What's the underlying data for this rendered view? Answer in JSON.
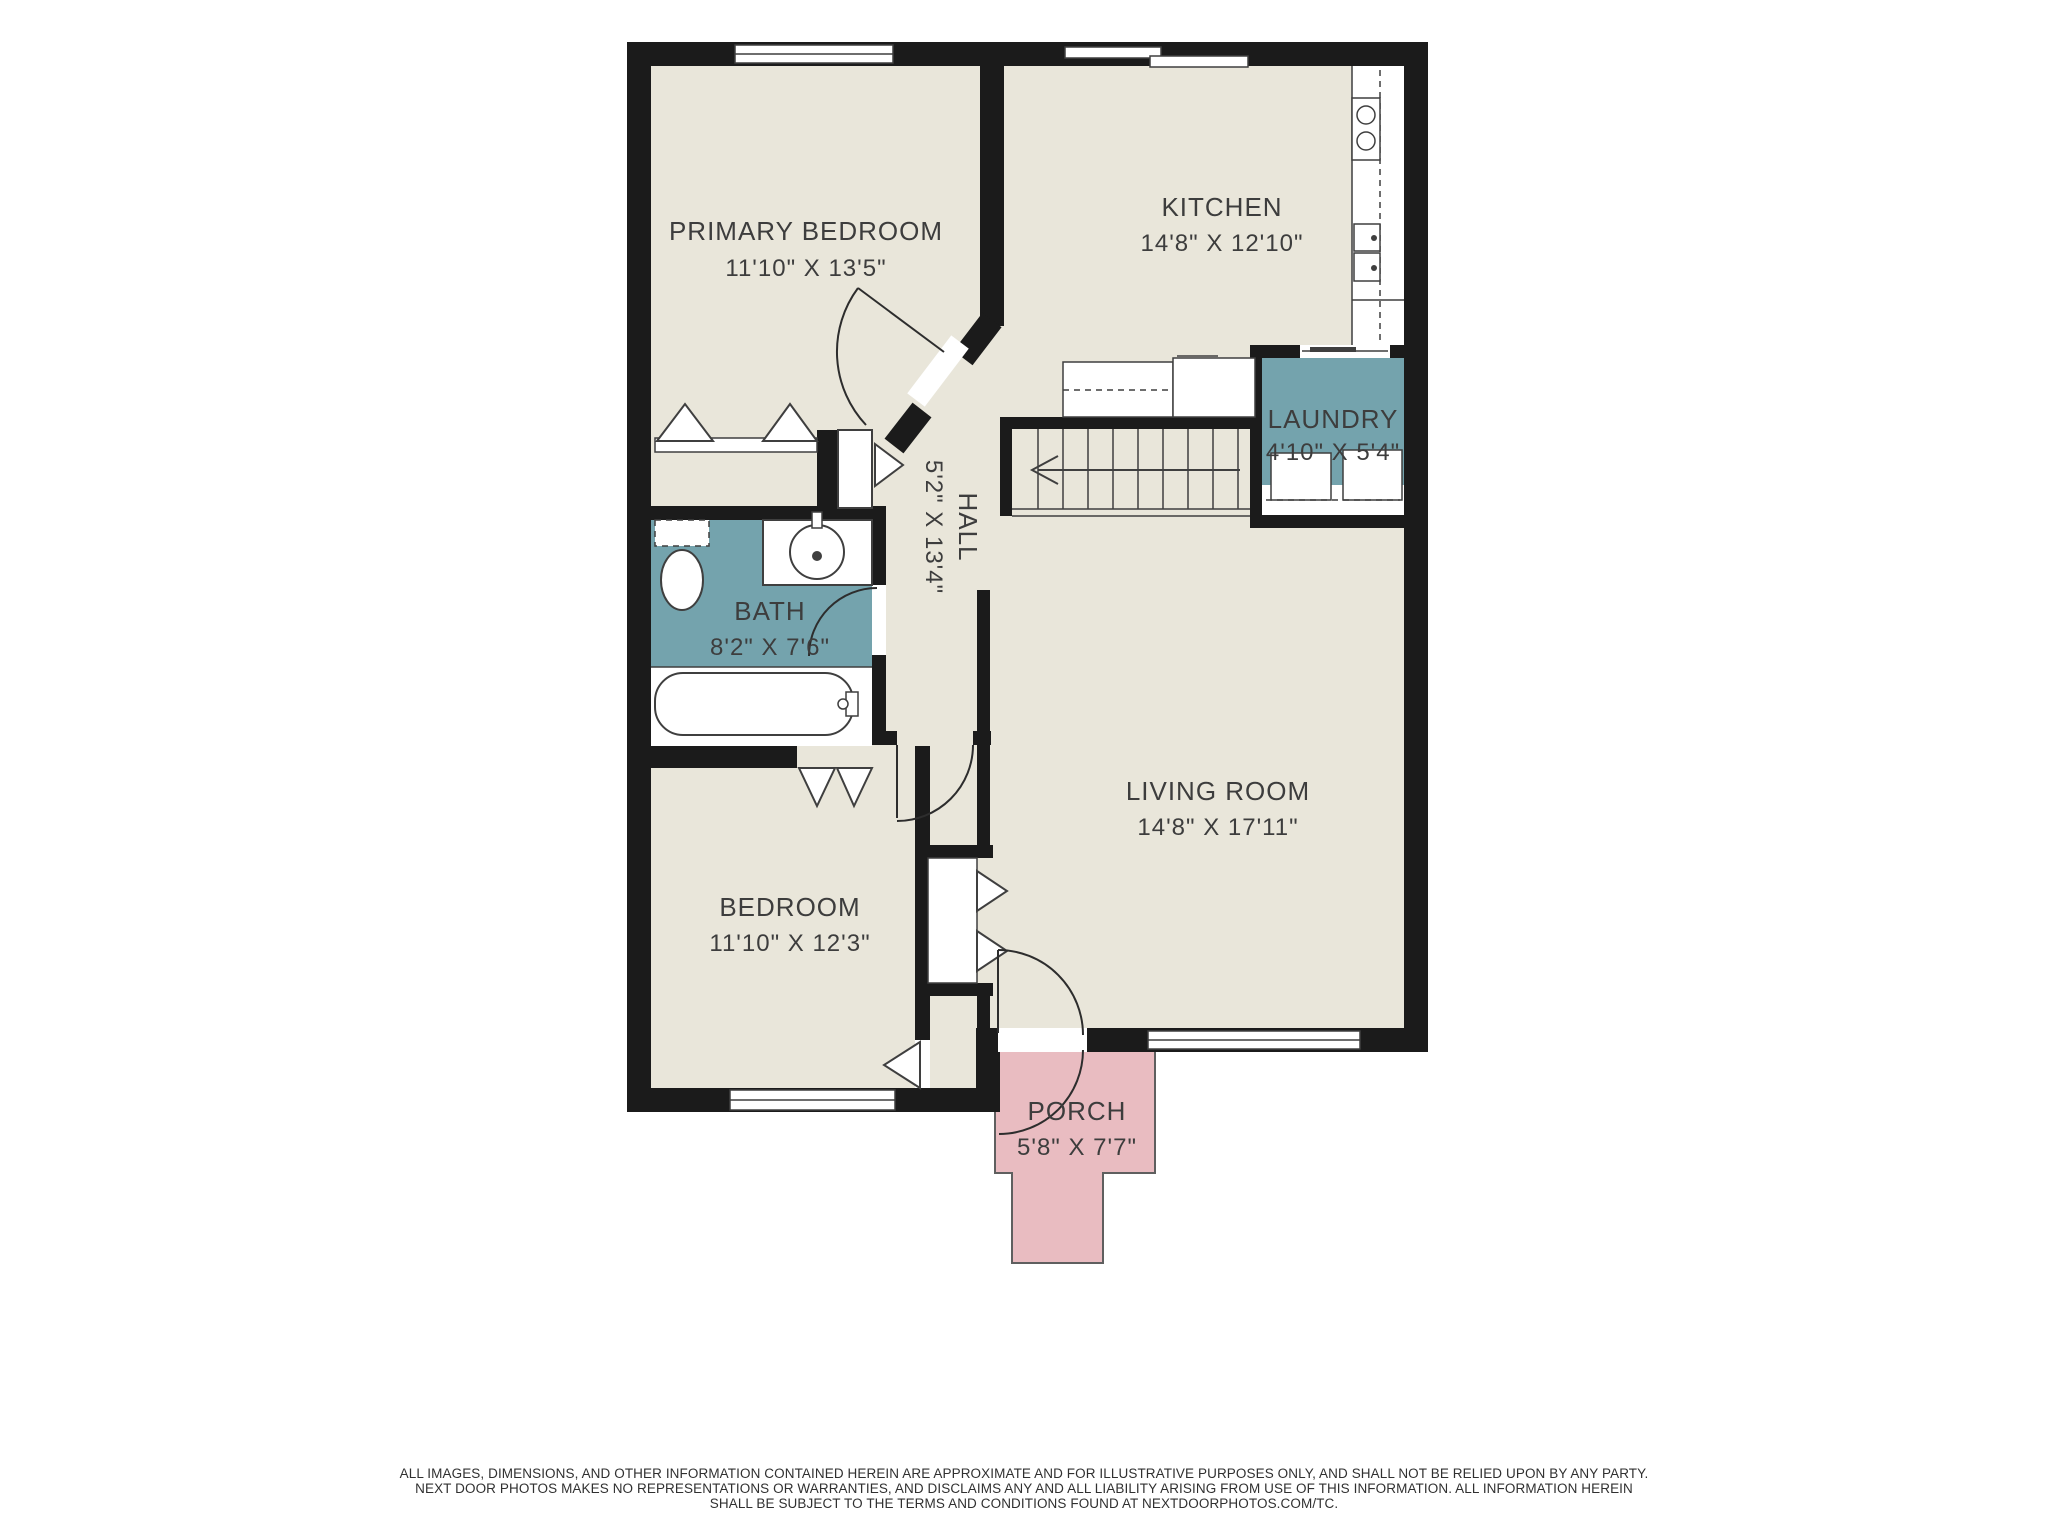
{
  "rooms": [
    {
      "id": "primary_bedroom",
      "name": "PRIMARY BEDROOM",
      "dims": "11'10\" X 13'5\""
    },
    {
      "id": "kitchen",
      "name": "KITCHEN",
      "dims": "14'8\" X 12'10\""
    },
    {
      "id": "laundry",
      "name": "LAUNDRY",
      "dims": "4'10\" X 5'4\""
    },
    {
      "id": "hall",
      "name": "HALL",
      "dims": "5'2\" X 13'4\""
    },
    {
      "id": "bath",
      "name": "BATH",
      "dims": "8'2\" X 7'6\""
    },
    {
      "id": "living_room",
      "name": "LIVING ROOM",
      "dims": "14'8\" X 17'11\""
    },
    {
      "id": "bedroom",
      "name": "BEDROOM",
      "dims": "11'10\" X 12'3\""
    },
    {
      "id": "porch",
      "name": "PORCH",
      "dims": "5'8\" X 7'7\""
    }
  ],
  "colors": {
    "wall": "#1b1b1b",
    "floor": "#e9e6da",
    "wet_room_teal": "#74a3ad",
    "porch_pink": "#e9bcc1",
    "label_text": "#3d3d3d"
  },
  "disclaimer": {
    "line1": "ALL IMAGES, DIMENSIONS, AND OTHER INFORMATION CONTAINED HEREIN ARE APPROXIMATE AND FOR ILLUSTRATIVE PURPOSES ONLY, AND SHALL NOT BE RELIED UPON BY ANY PARTY.",
    "line2": "NEXT DOOR PHOTOS MAKES NO REPRESENTATIONS OR WARRANTIES, AND DISCLAIMS ANY AND ALL LIABILITY ARISING FROM USE OF THIS INFORMATION. ALL INFORMATION HEREIN",
    "line3": "SHALL BE SUBJECT TO THE TERMS AND CONDITIONS FOUND AT NEXTDOORPHOTOS.COM/TC."
  }
}
